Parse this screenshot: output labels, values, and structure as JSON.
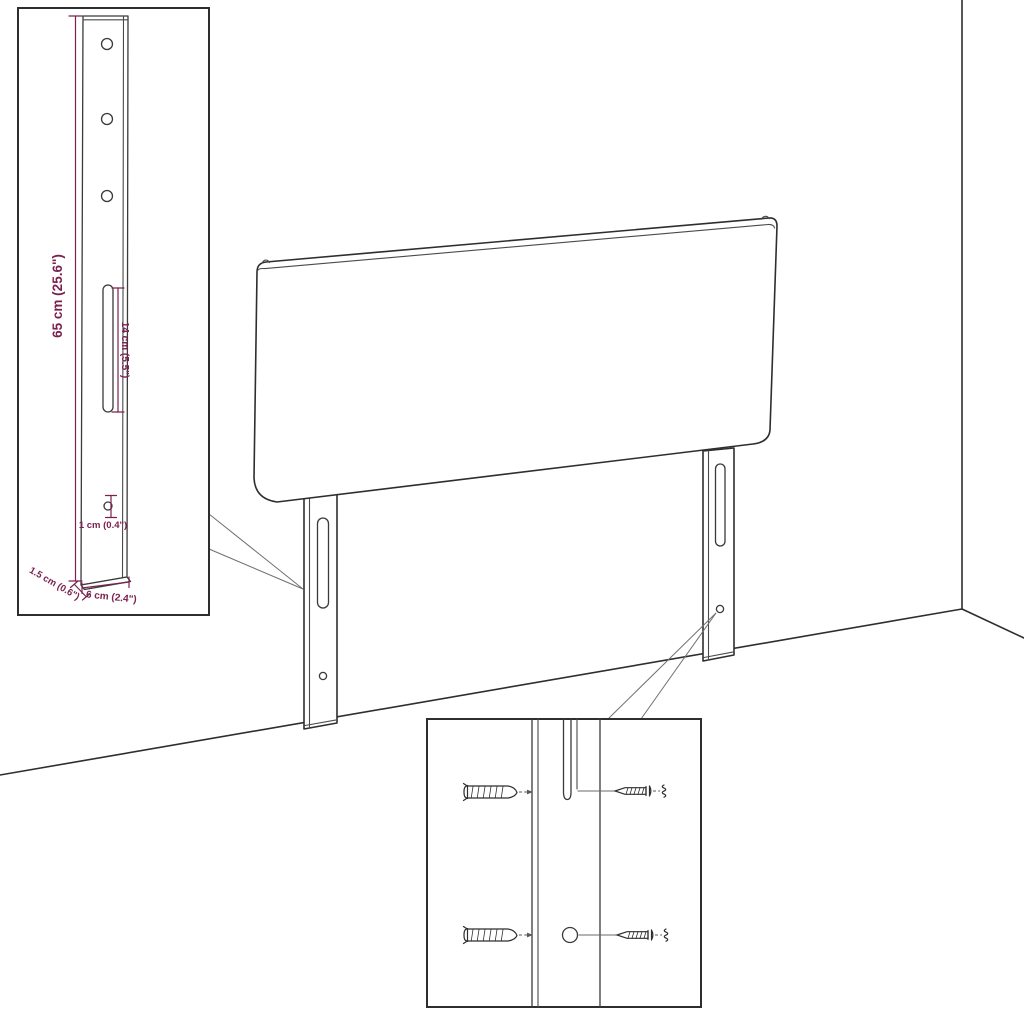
{
  "diagram": {
    "subject": "headboard-with-mounting-brackets",
    "colors": {
      "background": "#ffffff",
      "outline": "#2e2e2e",
      "dimension_text": "#7b2150",
      "pointer_line": "#707070"
    },
    "insets": {
      "bracket_detail": {
        "dimensions": {
          "height": "65 cm (25.6\")",
          "slot_length": "14 cm (5.5\")",
          "hole_diameter": "1 cm (0.4\")",
          "depth": "1.5 cm (0.6\")",
          "width": "6 cm (2.4\")"
        }
      },
      "mounting_detail": {
        "icons": [
          "wall-plug-icon",
          "screw-icon",
          "anchor-end-icon"
        ]
      }
    }
  }
}
